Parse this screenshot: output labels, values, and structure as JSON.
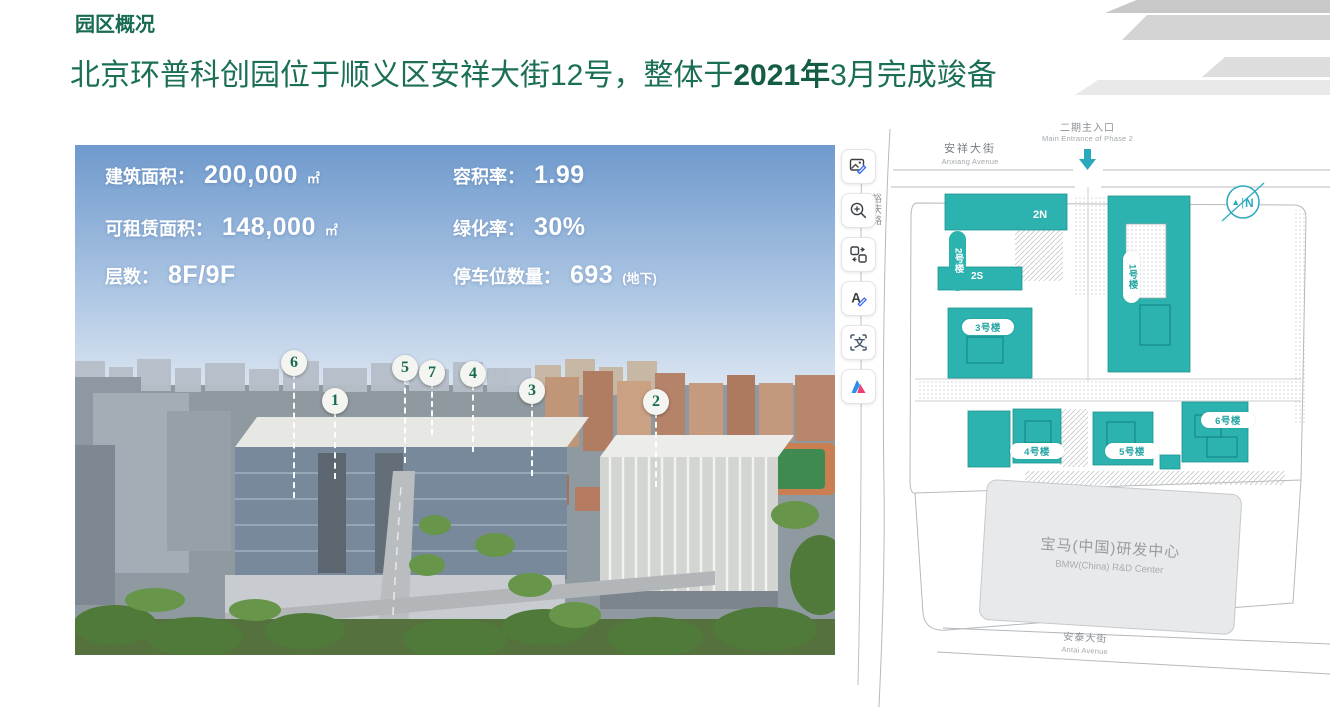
{
  "header": {
    "kicker": "园区概况",
    "title_pre": "北京环普科创园位于顺义区安祥大街12号，整体于",
    "title_year": "2021年",
    "title_post": "3月完成竣备"
  },
  "photo": {
    "stats_left": [
      {
        "label": "建筑面积：",
        "value": "200,000",
        "unit": "㎡"
      },
      {
        "label": "可租赁面积：",
        "value": "148,000",
        "unit": "㎡"
      },
      {
        "label": "层数：",
        "value": "8F/9F",
        "unit": ""
      }
    ],
    "stats_right": [
      {
        "label": "容积率：",
        "value": "1.99",
        "unit": ""
      },
      {
        "label": "绿化率：",
        "value": "30%",
        "unit": ""
      },
      {
        "label": "停车位数量：",
        "value": "693",
        "unit": "(地下)"
      }
    ],
    "markers": [
      {
        "n": "6"
      },
      {
        "n": "1"
      },
      {
        "n": "5"
      },
      {
        "n": "7"
      },
      {
        "n": "4"
      },
      {
        "n": "3"
      },
      {
        "n": "2"
      }
    ]
  },
  "toolbar": {
    "items": [
      "image-edit",
      "zoom-in",
      "replace-image",
      "text-edit",
      "translate-select",
      "ai-assistant"
    ]
  },
  "map": {
    "entrance_cn": "二期主入口",
    "entrance_en": "Main Entrance of Phase 2",
    "street_top_cn": "安祥大街",
    "street_top_en": "Anxiang Avenue",
    "road_left": "裕庆路",
    "north_label": "N",
    "buildings": {
      "b2n": "2N",
      "b2s": "2S",
      "b2": "2号楼",
      "b1": "1号楼",
      "b3": "3号楼",
      "b4": "4号楼",
      "b5": "5号楼",
      "b6": "6号楼"
    },
    "bmw_cn": "宝马(中国)研发中心",
    "bmw_en": "BMW(China) R&D Center",
    "street_bottom_cn": "安泰大街",
    "street_bottom_en": "Antai Avenue"
  },
  "colors": {
    "title_green": "#176b52",
    "building_teal": "#2cb2af",
    "compass_teal": "#2aa9bd"
  }
}
